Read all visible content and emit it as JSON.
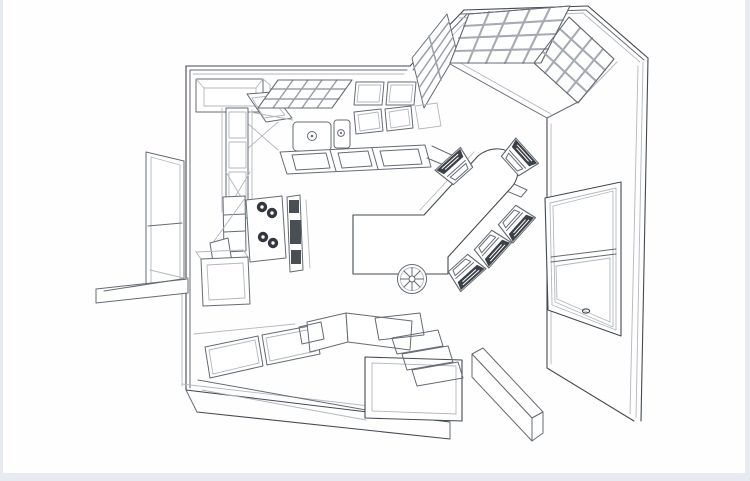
{
  "page": {
    "background": "#e8eaf1",
    "canvas_background": "#fefefe",
    "border_left_px": 3,
    "border_right_px": 5,
    "border_bottom_px": 8
  },
  "drawing": {
    "title": "Kitchen perspective floor plan - black and white line drawing, overhead 3/4 view",
    "type": "architectural-perspective-line-drawing",
    "palette": {
      "line": "#666b73",
      "line_dark": "#44494f",
      "line_light": "#b3b7be",
      "mullion": "#a6aab2",
      "shade": "#eceef2",
      "seat_dark": "#3c4047",
      "burner_dark": "#34383e",
      "appliance_dark": "#4a4f56"
    },
    "counts": {
      "chairs": 5,
      "burners": 4,
      "sink_basins": 2,
      "bay_lattice_windows": 3
    },
    "grids": {
      "bay_window_center": "4x5",
      "bay_window_right": "4x4",
      "upper_cabinet_lattice": "3x5"
    },
    "elements": [
      {
        "id": "room-walls",
        "desc": "L-shaped room with 45-degree bay corner at top right"
      },
      {
        "id": "bay-lattice-windows",
        "desc": "three gridded lattice windows wrapping the bay corner"
      },
      {
        "id": "right-wall",
        "desc": "tall right wall seen in perspective"
      },
      {
        "id": "double-hung-window",
        "desc": "double-hung sash window with center rail and latch in right wall"
      },
      {
        "id": "left-window",
        "desc": "tall divided window in left exterior wall"
      },
      {
        "id": "pass-through-ledge",
        "desc": "counter ledge protruding through left wall"
      },
      {
        "id": "upper-cabinets",
        "desc": "upper cabinet boxes along top wall"
      },
      {
        "id": "lattice-cabinet",
        "desc": "glass mullion cabinet doors over counter"
      },
      {
        "id": "double-basin-sink",
        "desc": "two sink basins with round drains in top counter"
      },
      {
        "id": "dishwasher-fronts",
        "desc": "paneled appliance fronts right of sink"
      },
      {
        "id": "drawer-band",
        "desc": "hatched drawer fronts under top counter"
      },
      {
        "id": "corner-counter",
        "desc": "angled counter run toward bay corner"
      },
      {
        "id": "pantry-cabinets",
        "desc": "tall paneled pantry cabinets on left run with open doors"
      },
      {
        "id": "range-cooktop",
        "desc": "cooktop with four dark burners"
      },
      {
        "id": "oven-stack",
        "desc": "dark wall-oven / range front panel"
      },
      {
        "id": "open-base-cabinet",
        "desc": "open base cabinet with shelves and swung door"
      },
      {
        "id": "base-cabinet",
        "desc": "framed base cabinet lower left"
      },
      {
        "id": "bottom-cabinet-panels",
        "desc": "two wide framed door panels on bottom run"
      },
      {
        "id": "raised-bar",
        "desc": "raised two-board bar top at bottom center island"
      },
      {
        "id": "grate-blocks",
        "desc": "hatched butcher-block grates on island"
      },
      {
        "id": "drawer-stack",
        "desc": "stepped stack of three hatched drawers, bottom right of island"
      },
      {
        "id": "dining-table",
        "desc": "angled peninsula dining table with rounded end"
      },
      {
        "id": "wagon-wheel",
        "desc": "spoked wheel under table edge"
      },
      {
        "id": "director-chairs",
        "desc": "five director-style chairs around table end"
      },
      {
        "id": "bench",
        "desc": "freestanding long low bench near right wall"
      }
    ]
  }
}
